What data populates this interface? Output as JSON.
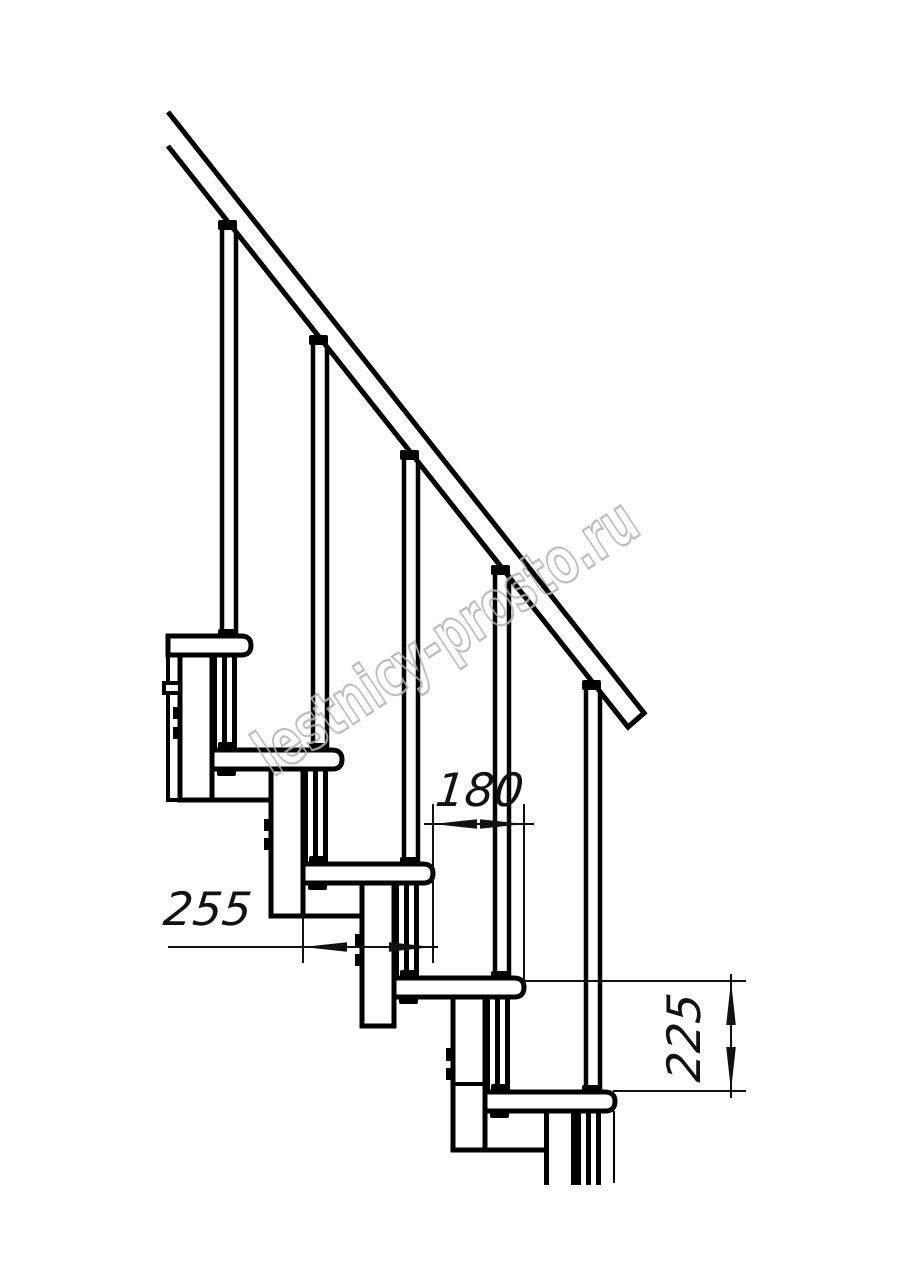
{
  "drawing": {
    "dimensions": {
      "run": {
        "value": "180",
        "orientation": "horizontal"
      },
      "tread_depth": {
        "value": "255",
        "orientation": "horizontal"
      },
      "rise": {
        "value": "225",
        "orientation": "vertical"
      }
    },
    "watermark": {
      "text": "lestnicy-prosto.ru",
      "color": "#b3b3b3"
    },
    "colors": {
      "line": "#000000",
      "dimension_line": "#111111",
      "background": "#ffffff"
    }
  }
}
